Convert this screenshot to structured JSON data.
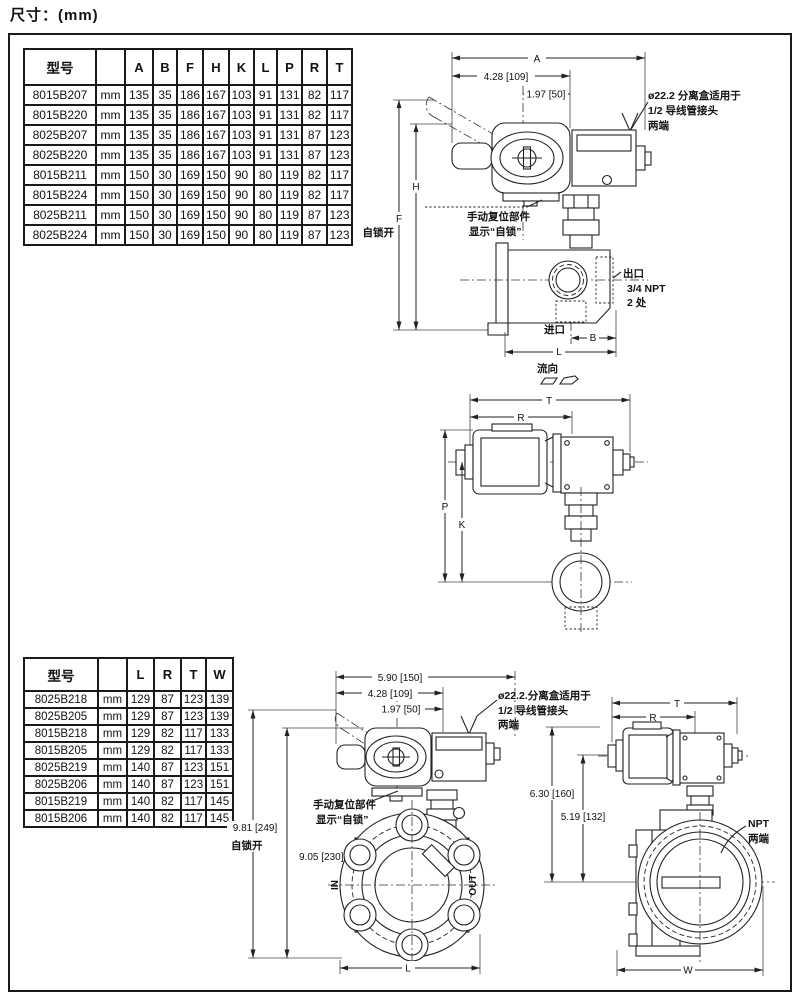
{
  "title": "尺寸：(mm)",
  "tables": {
    "t1": {
      "headers": [
        "型号",
        "",
        "A",
        "B",
        "F",
        "H",
        "K",
        "L",
        "P",
        "R",
        "T"
      ],
      "rows": [
        [
          "8015B207",
          "mm",
          "135",
          "35",
          "186",
          "167",
          "103",
          "91",
          "131",
          "82",
          "117"
        ],
        [
          "8015B220",
          "mm",
          "135",
          "35",
          "186",
          "167",
          "103",
          "91",
          "131",
          "82",
          "117"
        ],
        [
          "8025B207",
          "mm",
          "135",
          "35",
          "186",
          "167",
          "103",
          "91",
          "131",
          "87",
          "123"
        ],
        [
          "8025B220",
          "mm",
          "135",
          "35",
          "186",
          "167",
          "103",
          "91",
          "131",
          "87",
          "123"
        ],
        [
          "8015B211",
          "mm",
          "150",
          "30",
          "169",
          "150",
          "90",
          "80",
          "119",
          "82",
          "117"
        ],
        [
          "8015B224",
          "mm",
          "150",
          "30",
          "169",
          "150",
          "90",
          "80",
          "119",
          "82",
          "117"
        ],
        [
          "8025B211",
          "mm",
          "150",
          "30",
          "169",
          "150",
          "90",
          "80",
          "119",
          "87",
          "123"
        ],
        [
          "8025B224",
          "mm",
          "150",
          "30",
          "169",
          "150",
          "90",
          "80",
          "119",
          "87",
          "123"
        ]
      ]
    },
    "t2": {
      "headers": [
        "型号",
        "",
        "L",
        "R",
        "T",
        "W"
      ],
      "rows": [
        [
          "8025B218",
          "mm",
          "129",
          "87",
          "123",
          "139"
        ],
        [
          "8025B205",
          "mm",
          "129",
          "87",
          "123",
          "139"
        ],
        [
          "8015B218",
          "mm",
          "129",
          "82",
          "117",
          "133"
        ],
        [
          "8015B205",
          "mm",
          "129",
          "82",
          "117",
          "133"
        ],
        [
          "8025B219",
          "mm",
          "140",
          "87",
          "123",
          "151"
        ],
        [
          "8025B206",
          "mm",
          "140",
          "87",
          "123",
          "151"
        ],
        [
          "8015B219",
          "mm",
          "140",
          "82",
          "117",
          "145"
        ],
        [
          "8015B206",
          "mm",
          "140",
          "82",
          "117",
          "145"
        ]
      ]
    }
  },
  "d1": {
    "dim_a": "A",
    "dim_428": "4.28 [109]",
    "dim_197": "1.97 [50]",
    "note_conduit": [
      "ø22.2 分离盒适用于",
      "1/2 导线管接头",
      "两端"
    ],
    "dim_h": "H",
    "dim_f": "F",
    "lock_open": "自锁开",
    "note_manual": [
      "手动复位部件",
      "显示“自锁”"
    ],
    "outlet": [
      "出口",
      "3/4 NPT",
      "2 处"
    ],
    "inlet": "进口",
    "dim_b": "B",
    "dim_l": "L",
    "flow": "流向"
  },
  "d2": {
    "dim_t": "T",
    "dim_r": "R",
    "dim_p": "P",
    "dim_k": "K"
  },
  "d3": {
    "dim_590": "5.90 [150]",
    "dim_428": "4.28 [109]",
    "dim_197": "1.97 [50]",
    "note_conduit": [
      "ø22.2.分离盒适用于",
      "1/2 导线管接头",
      "两端"
    ],
    "note_manual": [
      "手动复位部件",
      "显示“自锁”"
    ],
    "dim_981": "9.81 [249]",
    "lock_open": "自锁开",
    "dim_905": "9.05 [230]",
    "label_in": "IN",
    "label_out": "OUT",
    "dim_l": "L"
  },
  "d4": {
    "dim_t": "T",
    "dim_r": "R",
    "dim_630": "6.30 [160]",
    "dim_519": "5.19 [132]",
    "note_npt": [
      "NPT",
      "两端"
    ],
    "dim_w": "W"
  }
}
